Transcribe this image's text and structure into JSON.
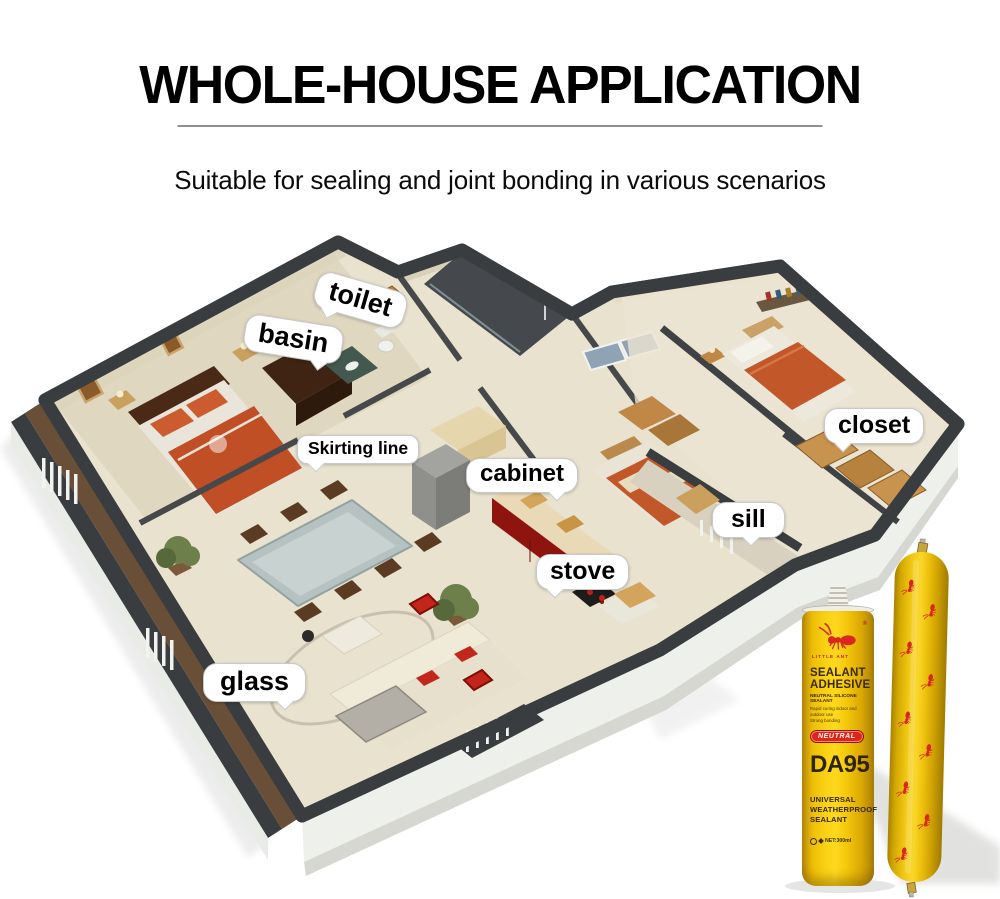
{
  "header": {
    "title": "WHOLE-HOUSE APPLICATION",
    "subtitle": "Suitable for sealing and joint bonding in various scenarios"
  },
  "callouts": [
    {
      "label": "toilet"
    },
    {
      "label": "basin"
    },
    {
      "label": "Skirting line"
    },
    {
      "label": "cabinet"
    },
    {
      "label": "closet"
    },
    {
      "label": "sill"
    },
    {
      "label": "stove"
    },
    {
      "label": "glass"
    }
  ],
  "product": {
    "brand": "LITTLE ANT",
    "registered_mark": "®",
    "title_line1": "SEALANT",
    "title_line2": "ADHESIVE",
    "subtitle": "NEUTRAL SILICONE SEALANT",
    "description_lines": [
      "Rapid curing indoor and",
      "outdoor use",
      "Strong bonding"
    ],
    "badge": "NEUTRAL",
    "model": "DA95",
    "type_lines": [
      "UNIVERSAL",
      "WEATHERPROOF",
      "SEALANT"
    ],
    "net_weight": "NET:300ml"
  },
  "colors": {
    "brand_yellow": "#F2C20A",
    "ant_red": "#D7281B",
    "badge_red": "#E02518",
    "wall_dark": "#3A3D3F",
    "floor_beige": "#E8E2CF",
    "bed_orange": "#C2572A",
    "kitchen_red": "#8E1410"
  }
}
